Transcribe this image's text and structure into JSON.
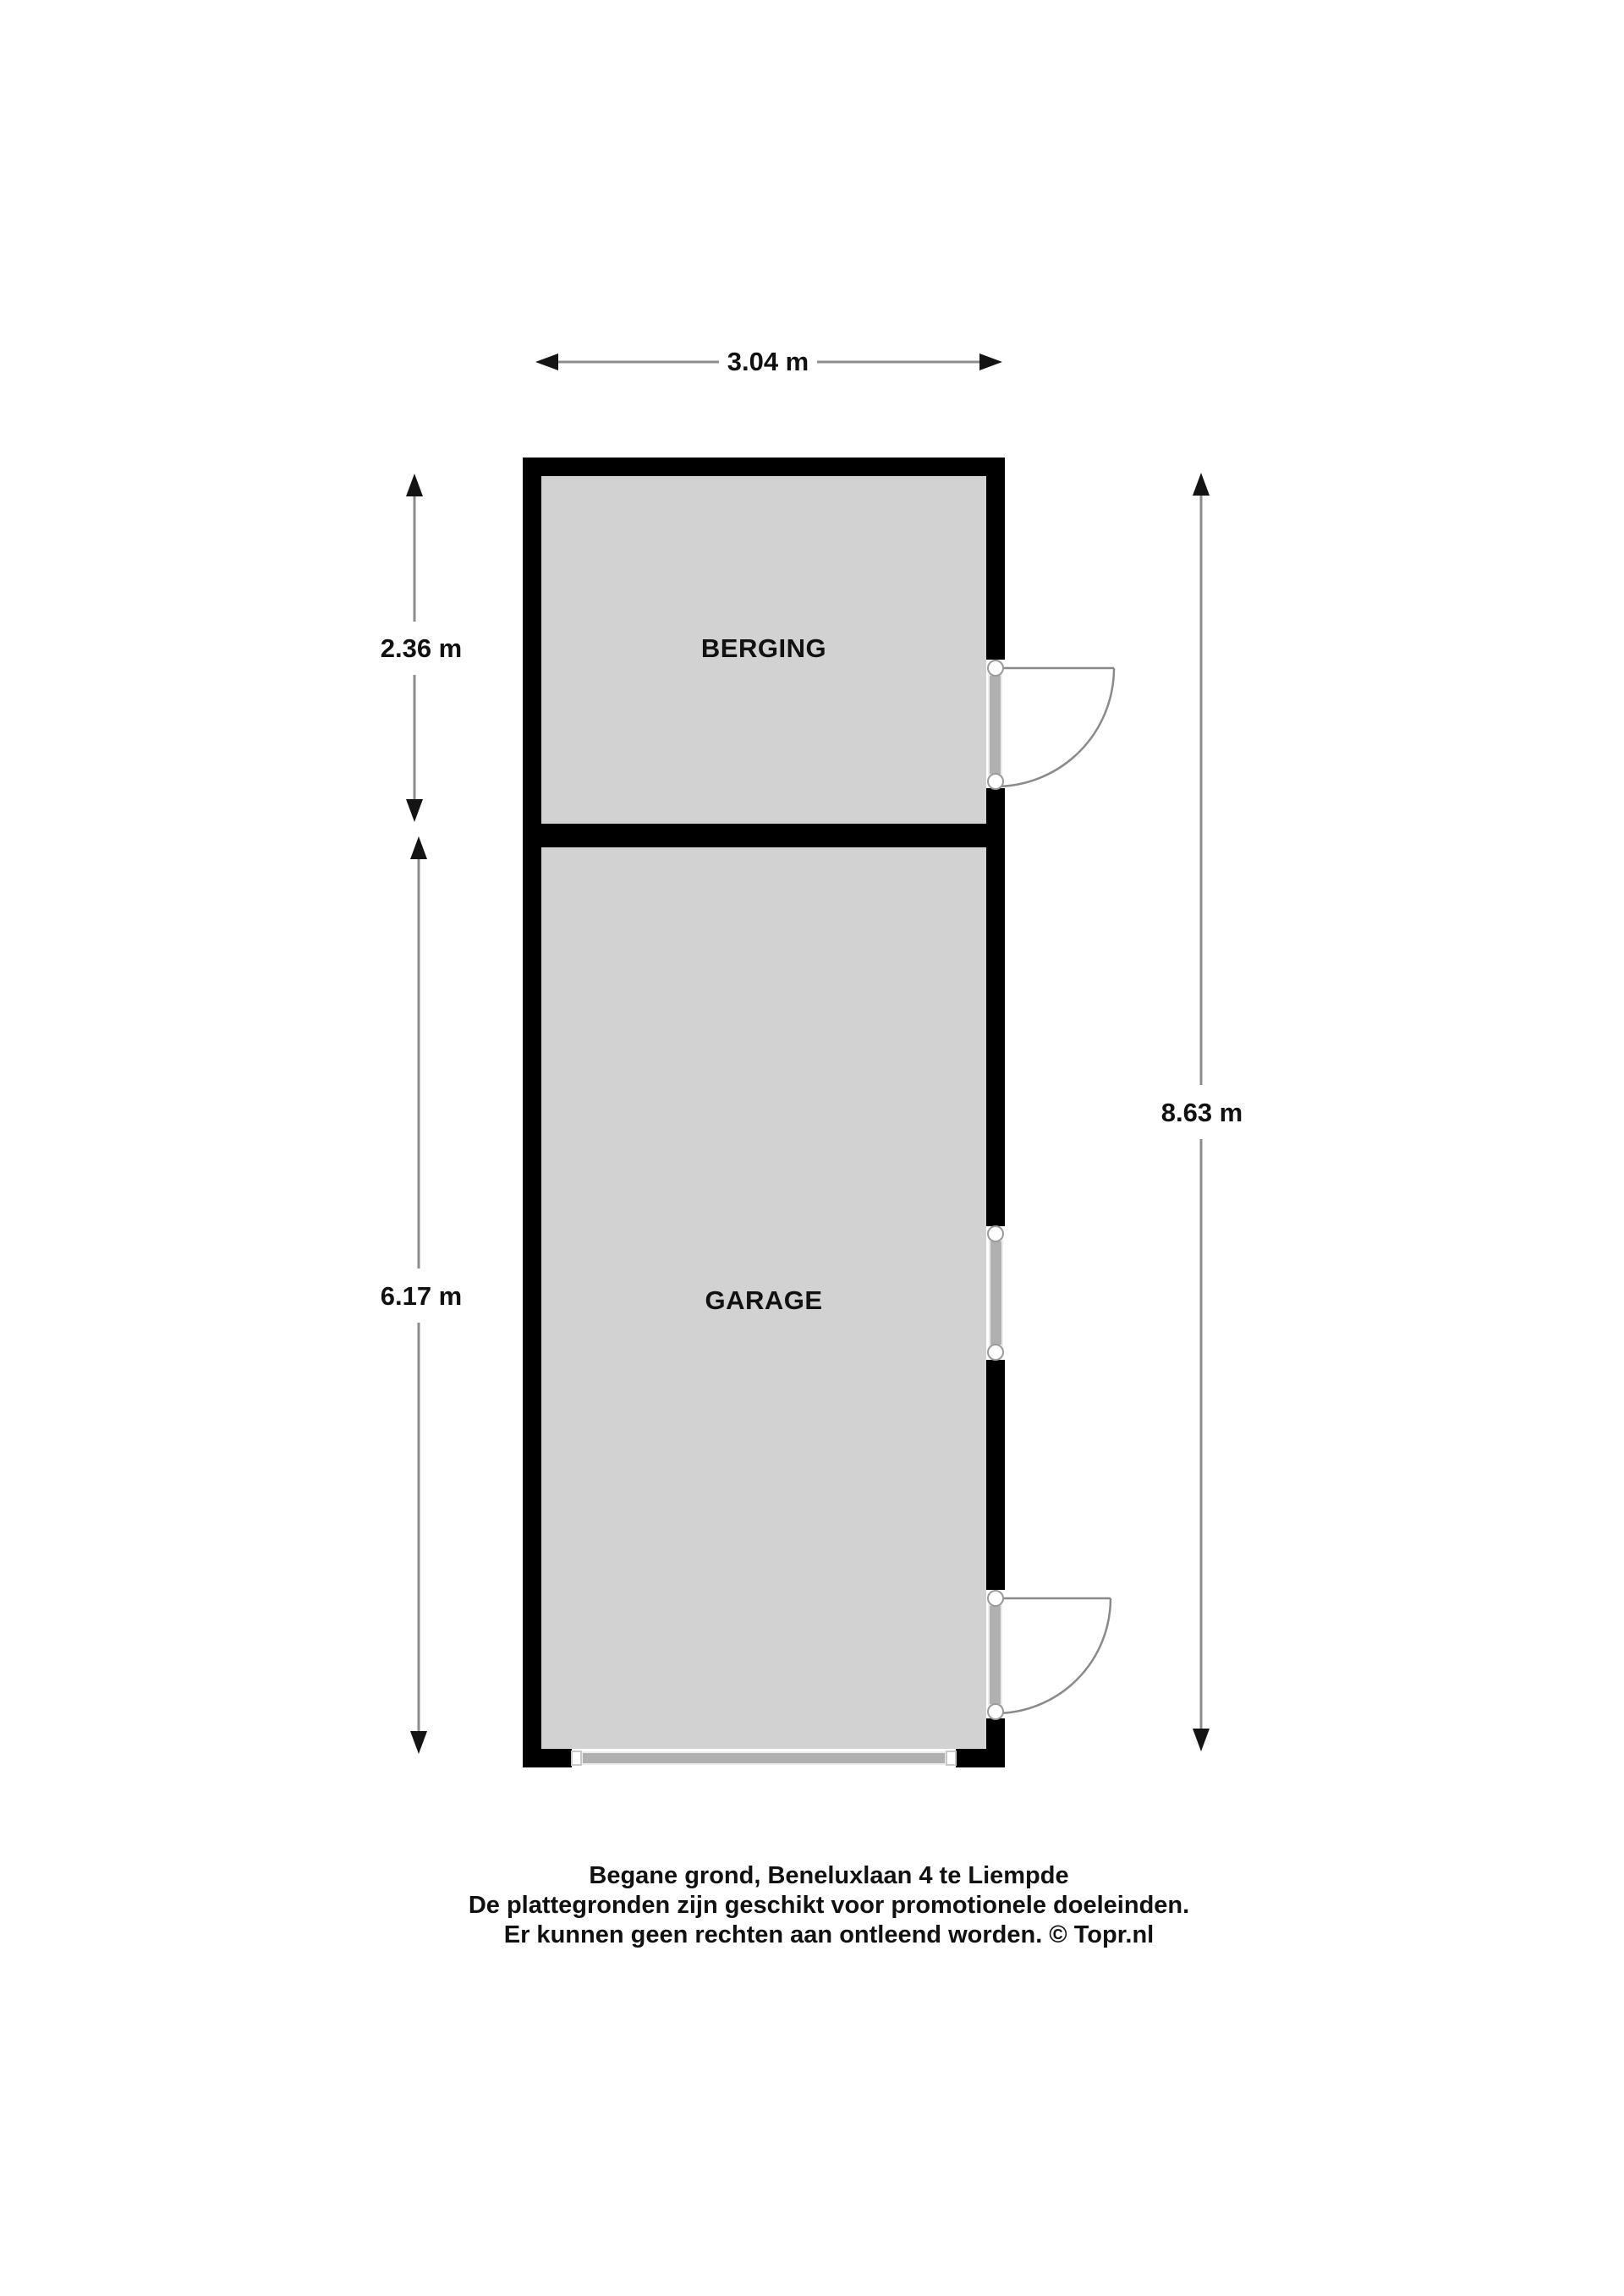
{
  "plan": {
    "rooms": [
      {
        "label": "BERGING"
      },
      {
        "label": "GARAGE"
      }
    ],
    "dimensions": {
      "width_top": "3.04 m",
      "berging_height": "2.36 m",
      "garage_height": "6.17 m",
      "total_height": "8.63 m"
    },
    "footer": {
      "lines": [
        "Begane grond, Beneluxlaan 4 te Liempde",
        "De plattegronden zijn geschikt voor promotionele doeleinden.",
        "Er kunnen geen rechten aan ontleend worden. © Topr.nl"
      ]
    },
    "colors": {
      "wall": "#000000",
      "floor": "#d2d2d2",
      "opening": "#ffffff",
      "fixture": "#b0b0b0",
      "dimension_line": "#8c8c8c",
      "text": "#111111",
      "background": "#ffffff"
    },
    "symbols": {
      "door_swing_icon": "quarter-circle-arc",
      "window_icon": "gray-sash-bar-with-end-dots",
      "overhead_garage_door_icon": "horizontal-gray-bar",
      "dimension_arrow_icon": "thin-triangle-arrowhead"
    }
  }
}
